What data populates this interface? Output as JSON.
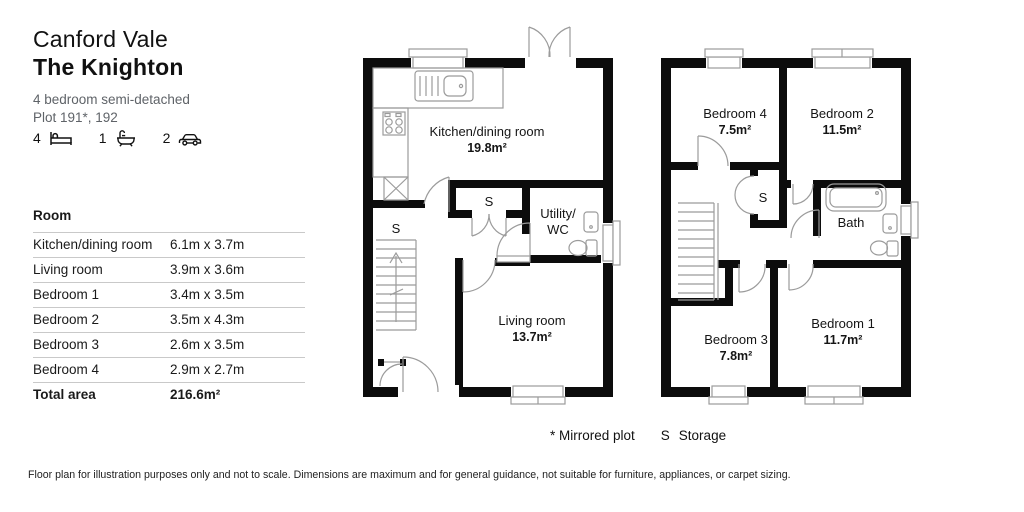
{
  "header": {
    "development": "Canford Vale",
    "house_name": "The Knighton",
    "type_line": "4 bedroom semi-detached",
    "plot_line": "Plot 191*, 192"
  },
  "stats": {
    "beds": "4",
    "baths": "1",
    "cars": "2"
  },
  "room_table": {
    "header": "Room",
    "rows": [
      {
        "room": "Kitchen/dining room",
        "dims": "6.1m x 3.7m"
      },
      {
        "room": "Living room",
        "dims": "3.9m x 3.6m"
      },
      {
        "room": "Bedroom 1",
        "dims": "3.4m x 3.5m"
      },
      {
        "room": "Bedroom 2",
        "dims": "3.5m x 4.3m"
      },
      {
        "room": "Bedroom 3",
        "dims": "2.6m x 3.5m"
      },
      {
        "room": "Bedroom 4",
        "dims": "2.9m x 2.7m"
      }
    ],
    "total_label": "Total area",
    "total_value": "216.6m²"
  },
  "ground_floor": {
    "kitchen": {
      "name": "Kitchen/dining room",
      "area": "19.8m²"
    },
    "living": {
      "name": "Living room",
      "area": "13.7m²"
    },
    "utility_line1": "Utility/",
    "utility_line2": "WC",
    "storage_closet": "S",
    "storage_understairs": "S"
  },
  "first_floor": {
    "bed4": {
      "name": "Bedroom 4",
      "area": "7.5m²"
    },
    "bed2": {
      "name": "Bedroom 2",
      "area": "11.5m²"
    },
    "bed3": {
      "name": "Bedroom 3",
      "area": "7.8m²"
    },
    "bed1": {
      "name": "Bedroom 1",
      "area": "11.7m²"
    },
    "bath": "Bath",
    "storage": "S"
  },
  "legend": {
    "mirrored": "* Mirrored plot",
    "storage_key": "S",
    "storage_label": "Storage"
  },
  "footer": "Floor plan for illustration purposes only and not to scale. Dimensions are maximum and for general guidance, not suitable for furniture, appliances, or carpet sizing.",
  "colors": {
    "wall": "#0c0c0c",
    "fixture_line": "#9b9b9b",
    "text": "#1a1a1a",
    "muted": "#5f6368",
    "table_divider": "#c9c9c9"
  }
}
